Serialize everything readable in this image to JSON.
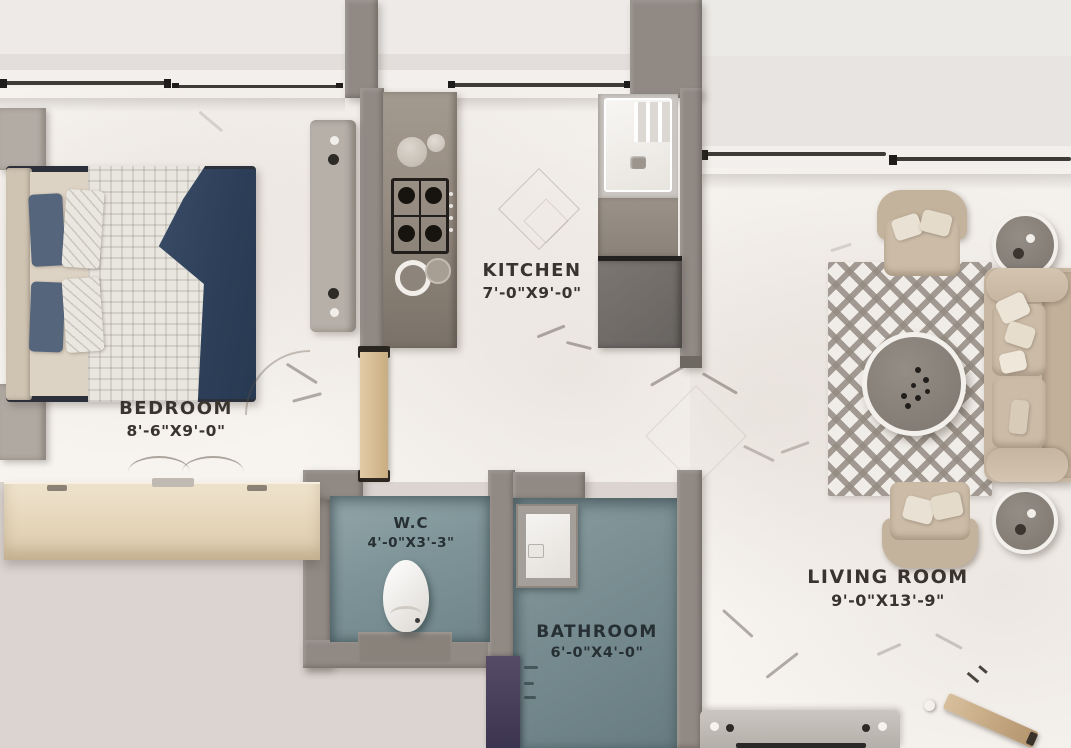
{
  "title": "apartment-floor-plan",
  "rooms": {
    "bedroom": {
      "name": "BEDROOM",
      "dims": "8'-6\"X9'-0\""
    },
    "kitchen": {
      "name": "KITCHEN",
      "dims": "7'-0\"X9'-0\""
    },
    "wc": {
      "name": "W.C",
      "dims": "4'-0\"X3'-3\""
    },
    "bathroom": {
      "name": "BATHROOM",
      "dims": "6'-0\"X4'-0\""
    },
    "living_room": {
      "name": "LIVING ROOM",
      "dims": "9'-0\"X13'-9\""
    }
  },
  "colors": {
    "wall": "#918a84",
    "floor_marble": "#f7f4f0",
    "wet_floor": "#7e9498",
    "bed_blanket_navy": "#31435c",
    "wood_door": "#d2b68c",
    "wardrobe_wood": "#e6d6b8",
    "sofa_beige": "#c8b8a3",
    "purple_accent": "#4b4157",
    "label_ink": "#3a342e"
  },
  "furniture": [
    "double-bed",
    "nightstand",
    "wardrobe",
    "dresser-cabinet",
    "kitchen-counter",
    "gas-stove",
    "kitchen-sink",
    "refrigerator",
    "toilet",
    "washbasin",
    "sofa",
    "armchair",
    "round-coffee-table",
    "round-side-table",
    "area-rug",
    "tv-console",
    "wooden-door"
  ]
}
